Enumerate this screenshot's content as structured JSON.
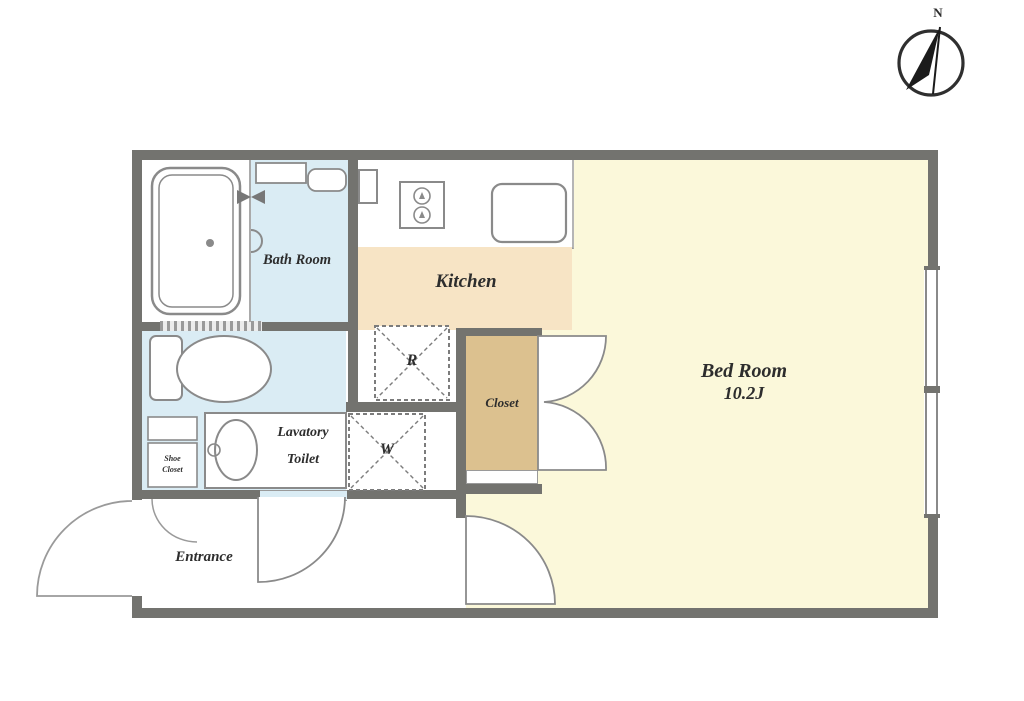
{
  "compass": {
    "label": "N"
  },
  "rooms": {
    "bath": {
      "label": "Bath Room"
    },
    "kitchen": {
      "label": "Kitchen"
    },
    "bedroom": {
      "label": "Bed Room",
      "size": "10.2J"
    },
    "lavatory": {
      "label_line1": "Lavatory",
      "label_line2": "Toilet"
    },
    "closet": {
      "label": "Closet"
    },
    "entrance": {
      "label": "Entrance"
    },
    "shoe_closet": {
      "label_line1": "Shoe",
      "label_line2": "Closet"
    },
    "refrigerator_space": {
      "label": "R"
    },
    "washer_space": {
      "label": "W"
    }
  },
  "colors": {
    "wall": "#73736f",
    "bath_floor": "#daecf4",
    "kitchen_floor": "#f7e4c5",
    "bedroom_floor": "#fbf8da",
    "closet_floor": "#dcc18f",
    "fixture_outline": "#8a8a8a",
    "label_text": "#2d2d2d"
  }
}
